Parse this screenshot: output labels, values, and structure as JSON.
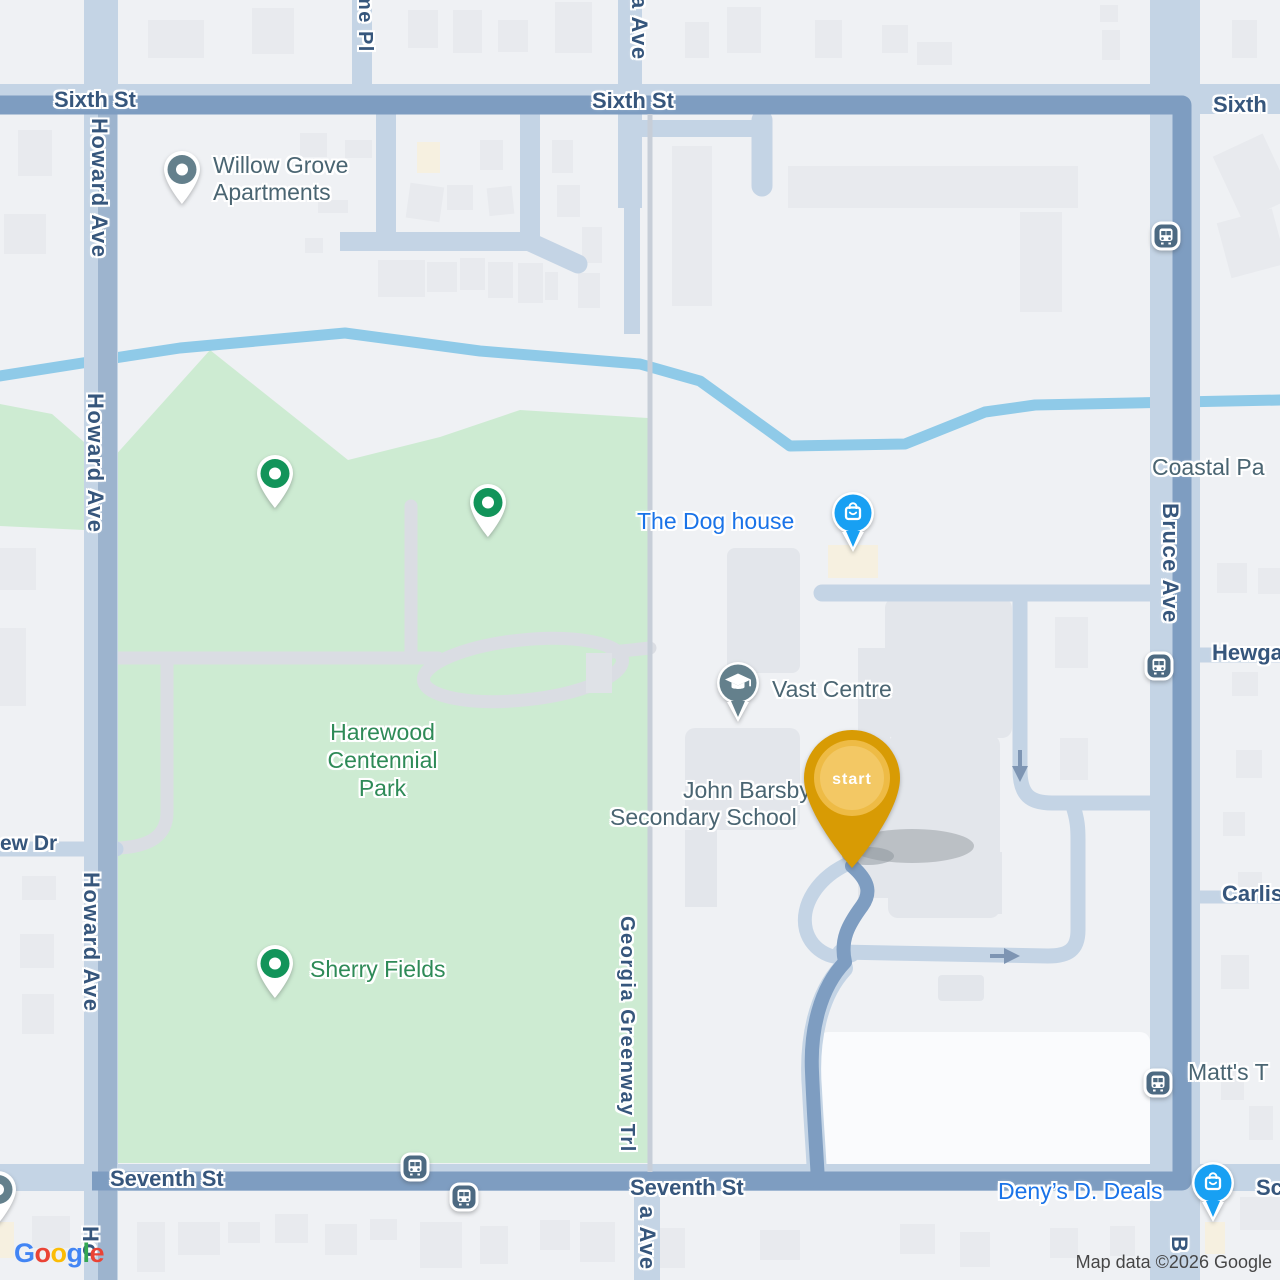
{
  "colors": {
    "route": "#7e9dc1",
    "road": "#c4d4e5",
    "road_fill": "#9db4ce",
    "water": "#8fcae8",
    "park": "#cdebd2",
    "background": "#eff1f4",
    "street_label": "#36567c",
    "poi_label": "#4a6572",
    "shop_label": "#1a73e8",
    "park_label": "#2e8a57",
    "start_pin": "#d89b04",
    "shop_pin": "#18a0f3",
    "poi_pin": "#64808c",
    "park_pin": "#12945a",
    "bus_icon": "#4d6a82"
  },
  "streets": {
    "sixth_a": "Sixth St",
    "sixth_b": "Sixth St",
    "sixth_c": "Sixth",
    "seventh_a": "Seventh St",
    "seventh_b": "Seventh St",
    "howard_a": "Howard Ave",
    "howard_b": "Howard Ave",
    "howard_c": "Howard Ave",
    "howard_d": "Ho",
    "bruce_a": "Bruce Ave",
    "bruce_b": "B",
    "georgia_greenway": "Georgia Greenway Trl",
    "georgia_top": "a Ave",
    "georgia_bottom": "a Ave",
    "me_pl": "me Pl",
    "ew_dr": "ew Dr",
    "hewgate": "Hewga",
    "carlisle": "Carlis",
    "sc": "Sc"
  },
  "places": {
    "willow_line1": "Willow Grove",
    "willow_line2": "Apartments",
    "dog_house": "The Dog house",
    "vast_centre": "Vast Centre",
    "school_line1": "John Barsby",
    "school_line2": "Secondary School",
    "harewood_line1": "Harewood",
    "harewood_line2": "Centennial",
    "harewood_line3": "Park",
    "sherry_fields": "Sherry Fields",
    "denys": "Deny’s D. Deals",
    "matts": "Matt's T",
    "coastal": "Coastal Pa"
  },
  "route_marker": {
    "start": "start"
  },
  "footer": {
    "logo": [
      "G",
      "o",
      "o",
      "g",
      "l",
      "e"
    ],
    "attribution": "Map data ©2026 Google"
  }
}
